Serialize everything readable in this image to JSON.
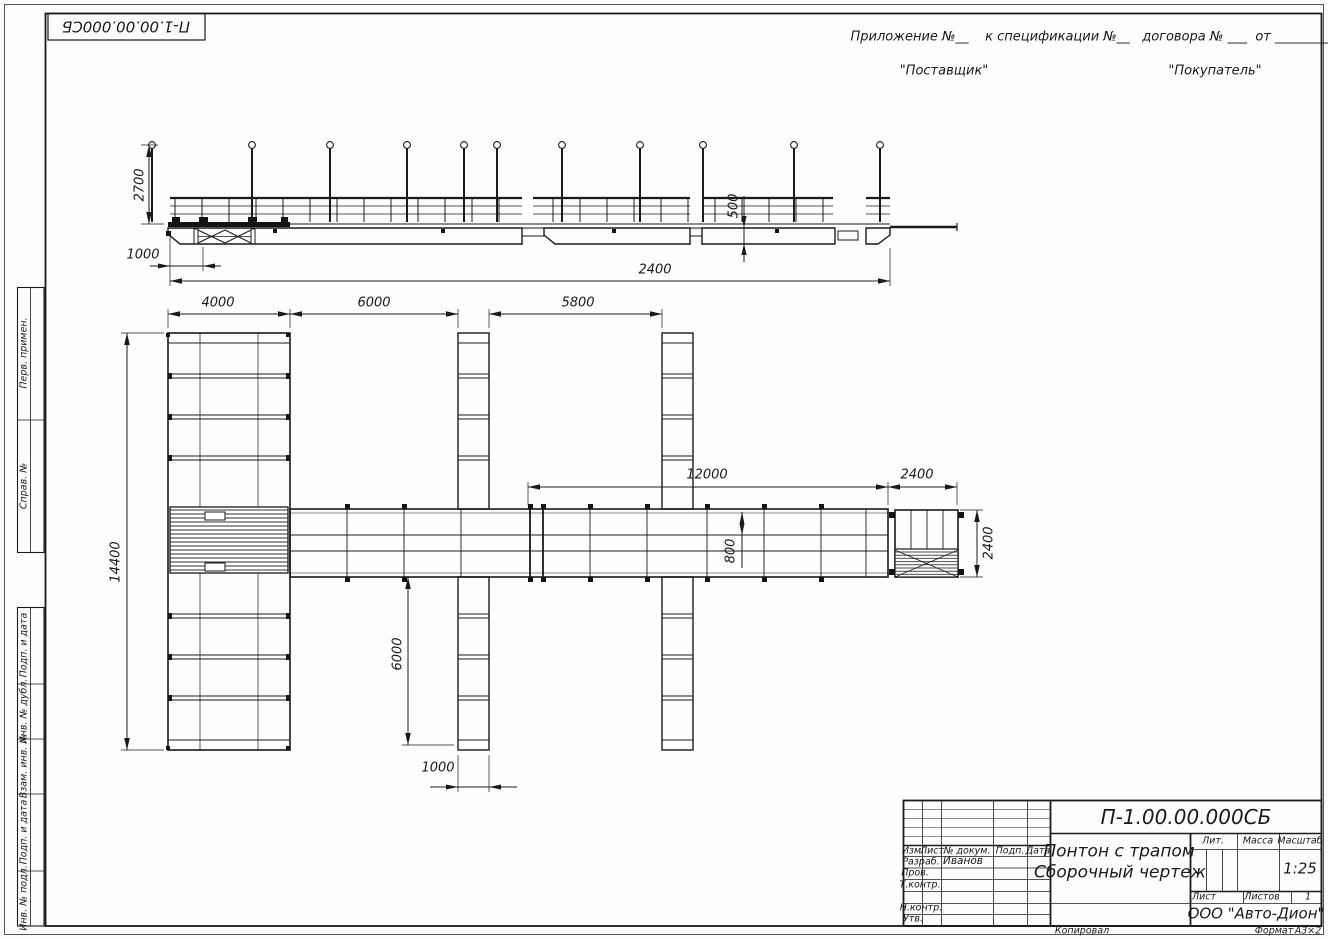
{
  "colors": {
    "line": "#1a1a1a",
    "paper": "#fdfdfd"
  },
  "doc": {
    "number": "П-1.00.00.000СБ",
    "title_line1": "Понтон с трапом",
    "title_line2": "Сборочный чертеж",
    "company": "ООО \"Авто-Дион\"",
    "scale": "1:25",
    "sheets_value": "1",
    "copied_label": "Копировал",
    "format_label": "Формат",
    "format_value": "А3×2"
  },
  "note": {
    "line1": "Приложение №__    к спецификации №__   договора № ___  от _________",
    "supplier": "\"Поставщик\"",
    "buyer": "\"Покупатель\""
  },
  "side_labels": {
    "perv": "Перв. примен.",
    "sprav": "Справ. №",
    "podp1": "Подп. и дата",
    "inv_dubl": "Инв. № дубл.",
    "vzam": "Взам. инв. №",
    "podp2": "Подп. и дата",
    "inv_podl": "Инв. № подл."
  },
  "title_block": {
    "izm": "Изм.",
    "list": "Лист",
    "n_dokum": "№ докум.",
    "podp": "Подп.",
    "data": "Дата",
    "razrab": "Разраб.",
    "razrab_name": "Иванов",
    "prov": "Пров.",
    "t_kontr": "Т.контр.",
    "n_kontr": "Н.контр.",
    "utv": "Утв.",
    "lit": "Лит.",
    "massa": "Масса",
    "masshtab": "Масштаб",
    "list2": "Лист",
    "listov": "Листов"
  },
  "dims": {
    "post_height": "2700",
    "ramp_offset": "1000",
    "draft": "500",
    "total_length": "2400",
    "pier_width": "4000",
    "bay1": "6000",
    "bay2": "5800",
    "walkway_length": "12000",
    "gangway_length": "2400",
    "gangway_width": "2400",
    "overall_width": "14400",
    "finger_length": "6000",
    "finger_width": "1000",
    "walkway_width": "800"
  }
}
